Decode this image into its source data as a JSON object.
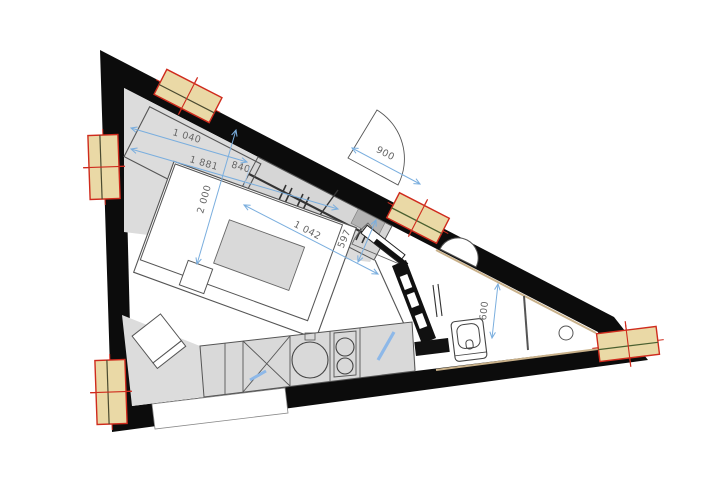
{
  "plan": {
    "type": "architectural-floor-plan",
    "rooms": [
      "main-room",
      "entry-hall",
      "bathroom",
      "kitchen-strip"
    ],
    "dimensions": {
      "d1": "1 040",
      "d2": "1 881",
      "d3": "840",
      "d4": "2 000",
      "d5": "1 042",
      "d6": "597",
      "d7": "900",
      "d8": "600"
    },
    "icons": {
      "window": "window-marker-icon",
      "entry_door": "entry-door-marker-icon",
      "door_swing": "door-swing-arc-icon",
      "clothes_rail": "clothes-rail-icon",
      "sink": "kitchen-sink-icon",
      "hob": "hob-burners-icon",
      "dishwasher": "crossed-cabinet-icon",
      "toilet": "toilet-icon",
      "corner_basin": "corner-basin-icon",
      "floor_drain": "floor-drain-icon",
      "towel_radiator": "towel-radiator-icon",
      "duct": "duct-shaft-icon"
    },
    "colors": {
      "wall": "#0c0c0c",
      "floor_zone": "#dcdcdc",
      "furniture_fill": "#d9d9d9",
      "window_fill": "#ead9a6",
      "window_accent": "#cf2b1d",
      "dimension_blue": "#7aaede",
      "outline_gray": "#555555",
      "lining_tan": "#c9b18a"
    }
  }
}
